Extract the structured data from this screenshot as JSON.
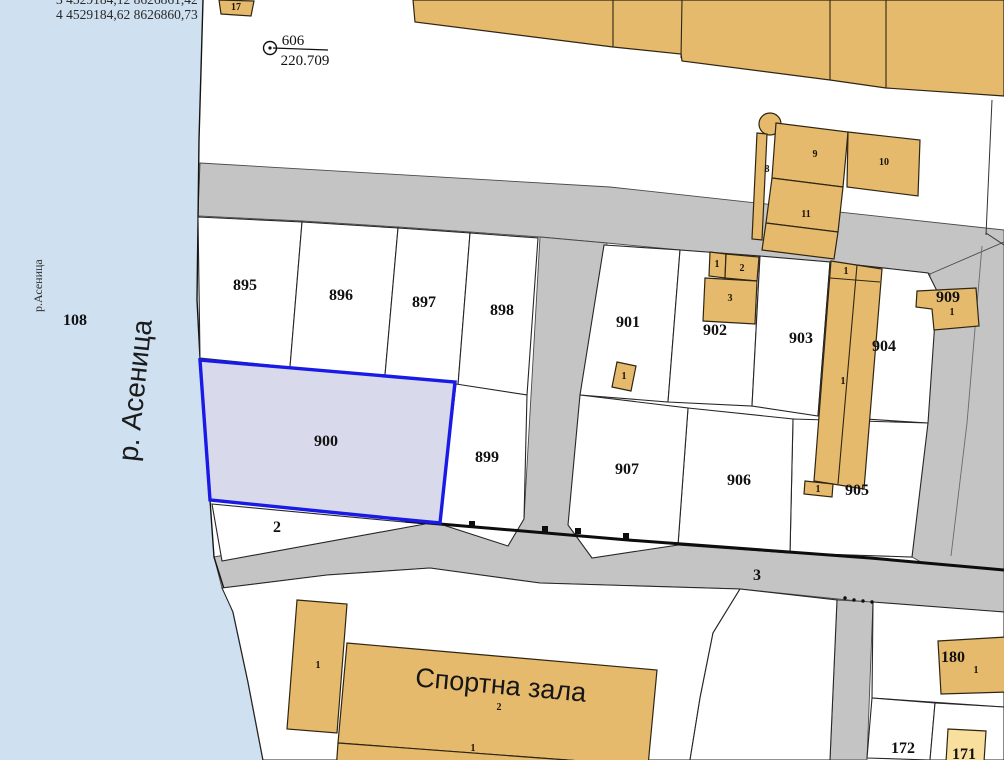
{
  "overlay": {
    "coord_line_clipped": "3   4529184,12 8626861,42",
    "coord_line": "4   4529184,62 8626860,73"
  },
  "benchmark": {
    "point_id": "606",
    "elevation": "220.709"
  },
  "river": {
    "label_large": "р. Асеница",
    "label_small": "р.Асеница"
  },
  "parcels": {
    "p108": "108",
    "p895": "895",
    "p896": "896",
    "p897": "897",
    "p898": "898",
    "p899": "899",
    "p900": "900",
    "p901": "901",
    "p902": "902",
    "p903": "903",
    "p904": "904",
    "p905": "905",
    "p906": "906",
    "p907": "907",
    "p909": "909",
    "p2": "2",
    "road3": "3",
    "p172": "172",
    "p171": "171",
    "p180": "180"
  },
  "buildings": {
    "b17": "17",
    "b8": "8",
    "b9": "9",
    "b10": "10",
    "b11": "11",
    "b902_1": "1",
    "b902_2": "2",
    "b902_3": "3",
    "b901_1": "1",
    "b904_top": "1",
    "b904_mid": "1",
    "b905_tab": "1",
    "b909_1": "1",
    "b_sport_left": "1",
    "b_sport_num": "2",
    "b_sport_lower": "1",
    "b180_1": "1",
    "sport_hall_name": "Спортна зала"
  },
  "colors": {
    "river": "#cfe0f0",
    "road": "#c4c4c4",
    "building": "#e6ba6c",
    "building_light": "#f8df9e",
    "highlight_fill": "#d9d9ec",
    "highlight_border": "#1a1ae6"
  }
}
